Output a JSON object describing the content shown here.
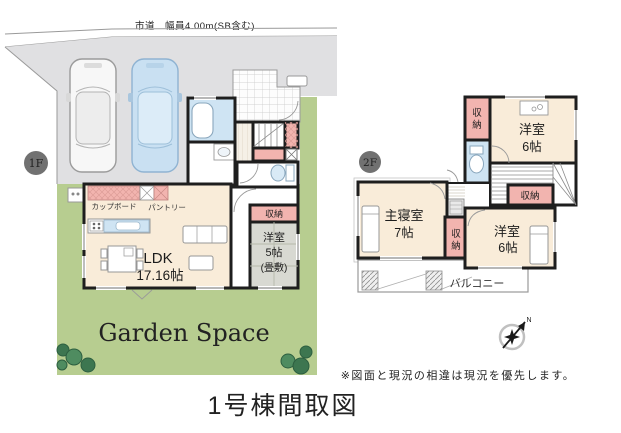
{
  "title": "1号棟間取図",
  "note": "※図面と現況の相違は現況を優先します。",
  "road_label": "市道　幅員4.00m(SB含む)",
  "compass_north": "N",
  "labels": {
    "storage": "収納",
    "storage_chars": [
      "収",
      "納"
    ]
  },
  "floor1": {
    "badge": "1F",
    "garden_label": "Garden Space",
    "rooms": {
      "bath": "浴室",
      "washroom": "洗面",
      "cupboard": "カップボード",
      "pantry": "パントリー",
      "ldk_name": "LDK",
      "ldk_size": "17.16帖",
      "tatami_name": "洋室",
      "tatami_size": "5帖",
      "tatami_note": "(畳敷)"
    }
  },
  "floor2": {
    "badge": "2F",
    "rooms": {
      "bedroom": {
        "name": "主寝室",
        "size": "7帖"
      },
      "room_top": {
        "name": "洋室",
        "size": "6帖"
      },
      "room_bottom": {
        "name": "洋室",
        "size": "6帖"
      },
      "balcony": "バルコニー"
    }
  },
  "colors": {
    "wall": "#1e1e1e",
    "room_cream": "#f9ecd9",
    "storage_pink": "#f2b4af",
    "water_blue": "#cfe4f3",
    "tatami_gray": "#d8d9d2",
    "garden_green": "#b7cd90",
    "garden_text_green": "#2f6e35",
    "driveway_gray": "#e0e0e2",
    "car_blue": "#c9e0f2"
  }
}
